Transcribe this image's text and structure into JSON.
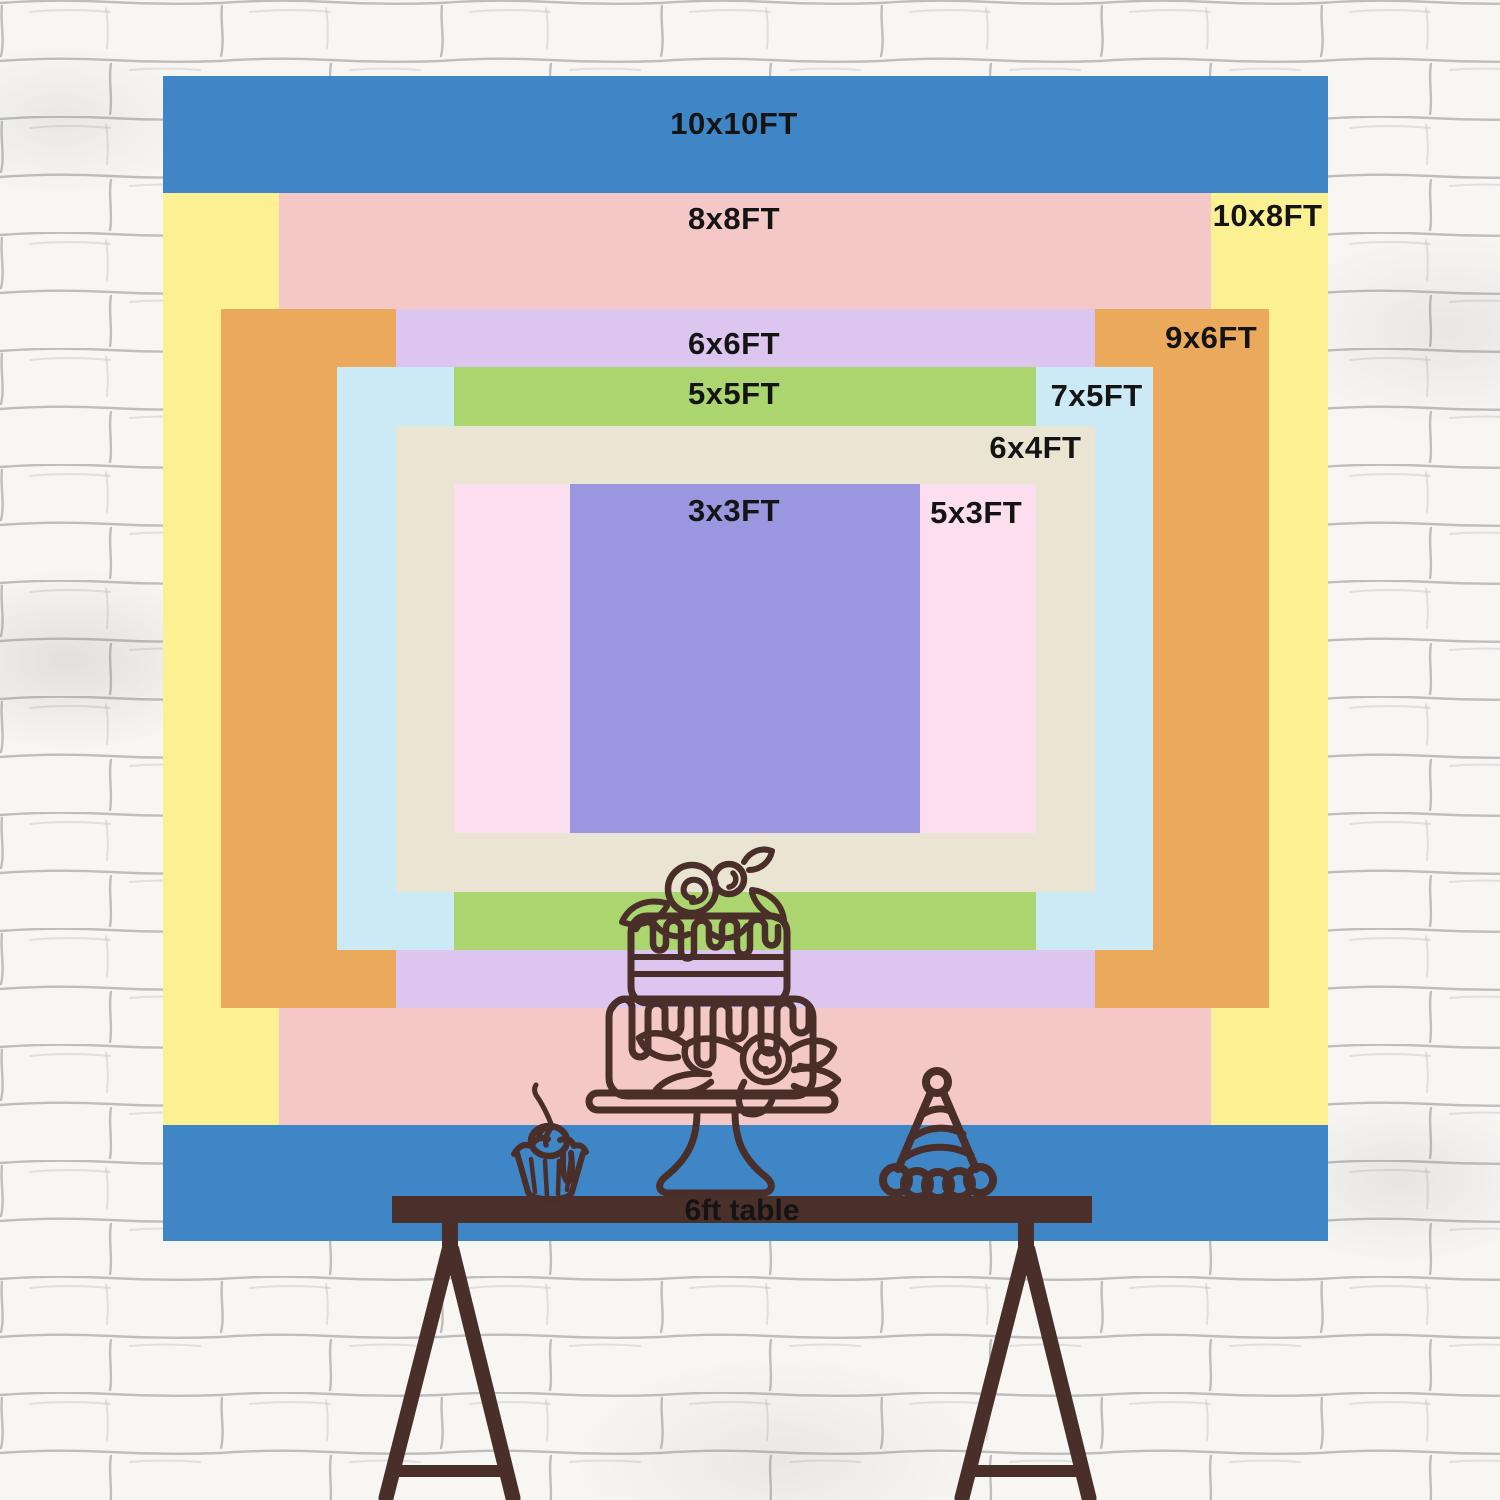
{
  "backdrop_chart": {
    "type": "nested-size-diagram",
    "unit": "FT",
    "label_color": "#141414",
    "sizes": [
      {
        "id": "10x10",
        "label": "10x10FT",
        "width_ft": 10,
        "height_ft": 10,
        "color": "#3f86c6",
        "label_pos": "top-center",
        "label_offset_top": 32
      },
      {
        "id": "10x8",
        "label": "10x8FT",
        "width_ft": 10,
        "height_ft": 8,
        "color": "#fcf192",
        "label_pos": "top-right",
        "label_offset_top": 7,
        "label_offset_right": 5
      },
      {
        "id": "8x8",
        "label": "8x8FT",
        "width_ft": 8,
        "height_ft": 8,
        "color": "#f5c8c8",
        "label_pos": "top-center",
        "label_offset_top": 10
      },
      {
        "id": "9x6",
        "label": "9x6FT",
        "width_ft": 9,
        "height_ft": 6,
        "color": "#eba95c",
        "label_pos": "top-right",
        "label_offset_top": 13,
        "label_offset_right": 12
      },
      {
        "id": "6x6",
        "label": "6x6FT",
        "width_ft": 6,
        "height_ft": 6,
        "color": "#dcc5ee",
        "label_pos": "top-center",
        "label_offset_top": 19
      },
      {
        "id": "7x5",
        "label": "7x5FT",
        "width_ft": 7,
        "height_ft": 5,
        "color": "#cbeaf6",
        "label_pos": "top-right",
        "label_offset_top": 13,
        "label_offset_right": 10
      },
      {
        "id": "5x5",
        "label": "5x5FT",
        "width_ft": 5,
        "height_ft": 5,
        "color": "#abd56e",
        "label_pos": "top-center",
        "label_offset_top": 11
      },
      {
        "id": "6x4",
        "label": "6x4FT",
        "width_ft": 6,
        "height_ft": 4,
        "color": "#eae4d2",
        "label_pos": "top-right",
        "label_offset_top": 6,
        "label_offset_right": 13
      },
      {
        "id": "5x3",
        "label": "5x3FT",
        "width_ft": 5,
        "height_ft": 3,
        "color": "#fbdfee",
        "label_pos": "top-right",
        "label_offset_top": 13,
        "label_offset_right": 14
      },
      {
        "id": "3x3",
        "label": "3x3FT",
        "width_ft": 3,
        "height_ft": 3,
        "color": "#9a97e0",
        "label_pos": "top-center",
        "label_offset_top": 11
      }
    ]
  },
  "table": {
    "label": "6ft table",
    "color": "#4a2f2b",
    "label_color": "#141414"
  },
  "illustration": {
    "stroke_color": "#4a2e29",
    "icons": [
      "cupcake-with-cherry-icon",
      "two-tier-cake-on-stand-icon",
      "party-hat-icon"
    ]
  },
  "wall": {
    "base_color": "#f7f6f3",
    "mortar_color": "#8f8f8f"
  }
}
